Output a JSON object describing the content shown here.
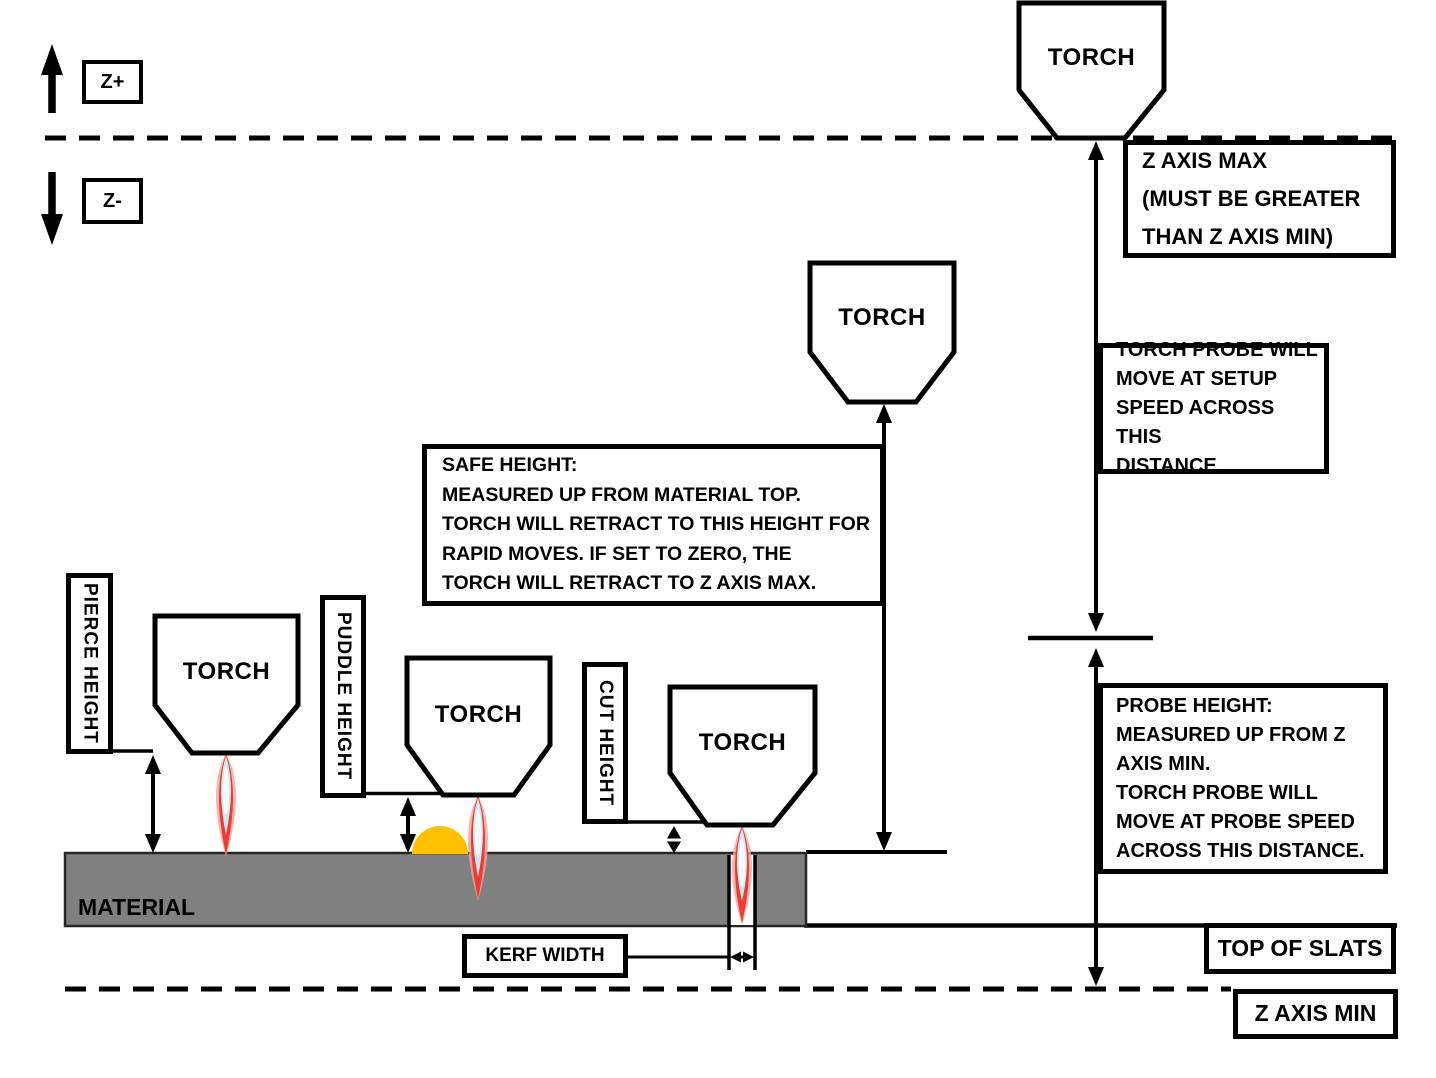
{
  "title": "Plasma torch Z-axis height settings diagram",
  "axis_controls": {
    "z_plus_label": "Z+",
    "z_minus_label": "Z-"
  },
  "torch_label": "TORCH",
  "callouts": {
    "z_axis_max": "Z AXIS MAX\n(MUST BE GREATER\nTHAN Z AXIS MIN)",
    "setup_speed": "TORCH PROBE WILL\nMOVE AT SETUP\nSPEED ACROSS THIS\nDISTANCE.",
    "probe_height": "PROBE HEIGHT:\nMEASURED UP FROM Z\nAXIS MIN.\nTORCH PROBE WILL\nMOVE AT PROBE SPEED\nACROSS THIS DISTANCE.",
    "safe_height": "SAFE HEIGHT:\nMEASURED UP FROM MATERIAL TOP.\nTORCH WILL RETRACT TO THIS HEIGHT FOR\nRAPID MOVES.  IF SET TO ZERO, THE\nTORCH WILL RETRACT TO Z AXIS MAX.",
    "pierce_height": "PIERCE HEIGHT",
    "puddle_height": "PUDDLE HEIGHT",
    "cut_height": "CUT HEIGHT",
    "kerf_width": "KERF WIDTH",
    "top_of_slats": "TOP OF SLATS",
    "z_axis_min": "Z AXIS MIN",
    "material": "MATERIAL"
  },
  "colors": {
    "line": "#000000",
    "material_fill": "#808080",
    "material_edge": "#262626",
    "puddle": "#ffc000",
    "flame_glow": "#f9a09a",
    "flame_red": "#ee3a30",
    "flame_blue": "#c7e9f3",
    "flame_core": "#f2fbfd"
  }
}
